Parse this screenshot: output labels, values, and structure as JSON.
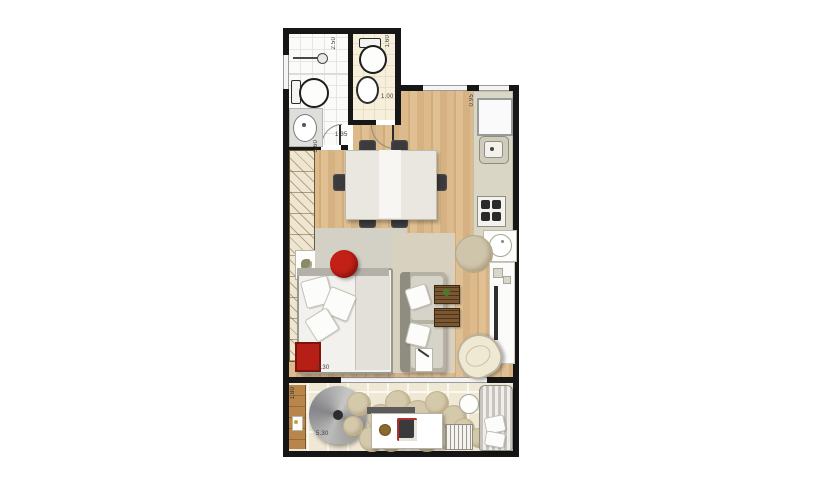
{
  "plan": {
    "type": "apartment-floor-plan",
    "labels": {
      "bath1_depth": "2.50",
      "bath2_depth": "1.60",
      "bath2_door_width": "1.00",
      "bath1_door_width": "1.35",
      "living_length": "5.60",
      "kitchen_counter_width": "0.95",
      "living_width": "5.30",
      "balcony_width": "5.30",
      "balcony_depth": "1.80"
    },
    "colors": {
      "wall": "#161616",
      "wood_floor": "#d9b788",
      "bath_tile": "#fbfbf9",
      "cream_tile": "#f6efdc",
      "balcony_tile": "#efe8d4",
      "counter": "#d9d6c6",
      "rug_gray": "#d3d0c5",
      "rug_beige": "#d8d1c0",
      "accent_red": "#c32017",
      "pouf_beige": "#cfc5ab",
      "deck_wood": "#b07c42"
    },
    "balcony": {
      "circles": [
        {
          "x": 60,
          "y": 388,
          "d": 18
        },
        {
          "x": 64,
          "y": 364,
          "d": 22
        },
        {
          "x": 84,
          "y": 376,
          "d": 26
        },
        {
          "x": 102,
          "y": 362,
          "d": 24
        },
        {
          "x": 120,
          "y": 372,
          "d": 28
        },
        {
          "x": 142,
          "y": 363,
          "d": 22
        },
        {
          "x": 158,
          "y": 377,
          "d": 24
        },
        {
          "x": 76,
          "y": 398,
          "d": 24
        },
        {
          "x": 96,
          "y": 400,
          "d": 22
        },
        {
          "x": 130,
          "y": 396,
          "d": 26
        },
        {
          "x": 152,
          "y": 398,
          "d": 22
        },
        {
          "x": 170,
          "y": 390,
          "d": 20
        },
        {
          "x": 186,
          "y": 400,
          "d": 18
        },
        {
          "x": 112,
          "y": 392,
          "d": 18
        }
      ]
    }
  }
}
